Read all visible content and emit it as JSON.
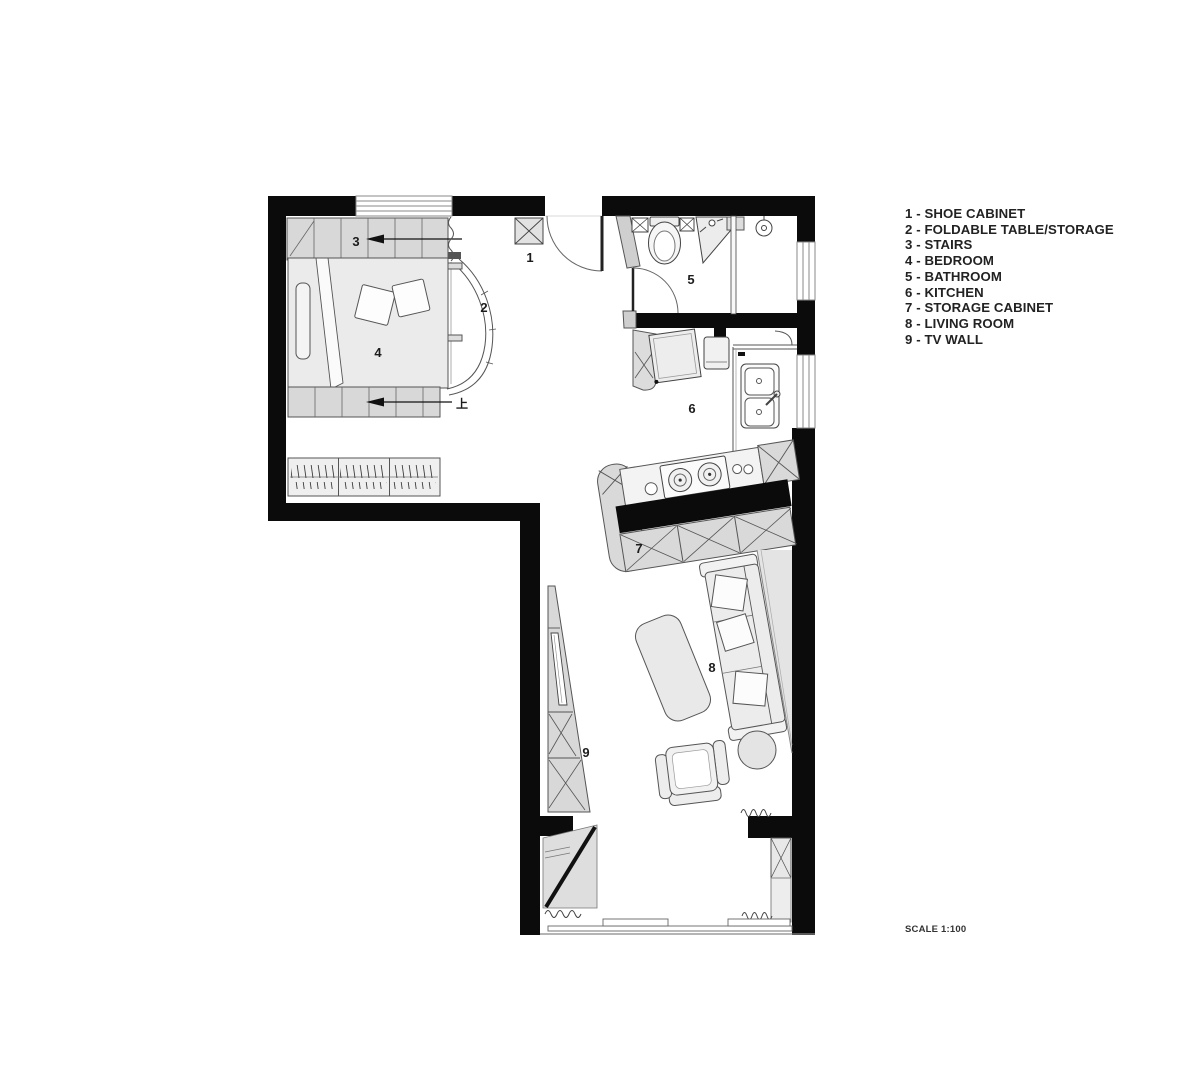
{
  "legend": {
    "items": [
      "1 - SHOE CABINET",
      "2 - FOLDABLE TABLE/STORAGE",
      "3 - STAIRS",
      "4 - BEDROOM",
      "5 - BATHROOM",
      "6 - KITCHEN",
      "7 - STORAGE CABINET",
      "8 - LIVING ROOM",
      "9 - TV WALL"
    ]
  },
  "scale_note": "SCALE 1:100",
  "plan": {
    "labels": [
      {
        "id": "shoe-cabinet",
        "text": "1"
      },
      {
        "id": "foldable-table",
        "text": "2"
      },
      {
        "id": "stairs",
        "text": "3"
      },
      {
        "id": "bedroom",
        "text": "4"
      },
      {
        "id": "bathroom",
        "text": "5"
      },
      {
        "id": "kitchen",
        "text": "6"
      },
      {
        "id": "storage-cabinet",
        "text": "7"
      },
      {
        "id": "living-room",
        "text": "8"
      },
      {
        "id": "tv-wall",
        "text": "9"
      },
      {
        "id": "stairs-up-mark",
        "text": "上"
      }
    ]
  },
  "fixtures": [
    "shoe-cabinet",
    "stairs-up",
    "bed",
    "pillows",
    "wardrobe",
    "foldable-table",
    "toilet",
    "corner-sink",
    "shower-head",
    "fridge",
    "washing-machine",
    "kitchen-sink",
    "gas-stove",
    "storage-cabinet",
    "sofa",
    "coffee-table",
    "armchair",
    "side-table",
    "tv-cabinet",
    "sliding-window"
  ],
  "colors": {
    "wall": "#0b0b0b",
    "background": "#ffffff",
    "furniture_fill": "#e9e9e9",
    "furniture_stroke": "#555555",
    "stairs_fill": "#d8d8d8",
    "legend_text": "#222222"
  }
}
